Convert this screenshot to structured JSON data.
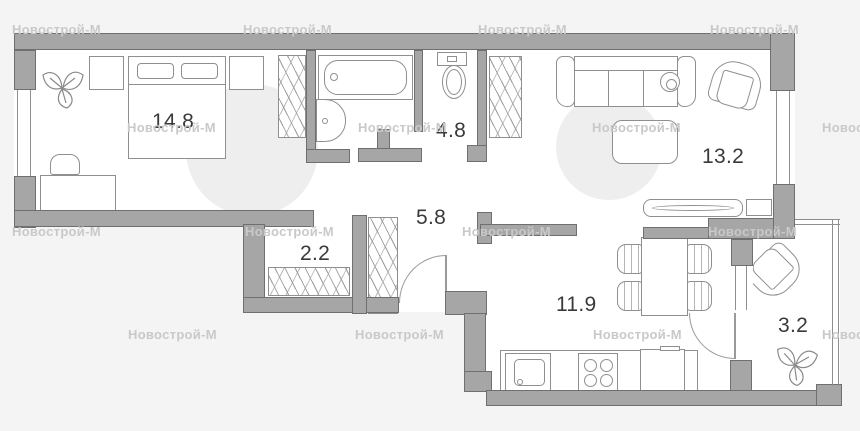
{
  "watermark": {
    "text": "Новострой-М"
  },
  "rooms": [
    {
      "id": "bedroom",
      "area": "14.8"
    },
    {
      "id": "bathroom",
      "area": "4.8"
    },
    {
      "id": "living-room",
      "area": "13.2"
    },
    {
      "id": "hallway",
      "area": "5.8"
    },
    {
      "id": "closet",
      "area": "2.2"
    },
    {
      "id": "kitchen-living",
      "area": "11.9"
    },
    {
      "id": "balcony",
      "area": "3.2"
    }
  ],
  "colors": {
    "wall": "#a6a6a6",
    "wall_outline": "#6f6f6f",
    "background": "#f4f4f4",
    "room_fill": "#ffffff",
    "label": "#3a3a3a",
    "watermark": "#c9c9c9"
  }
}
